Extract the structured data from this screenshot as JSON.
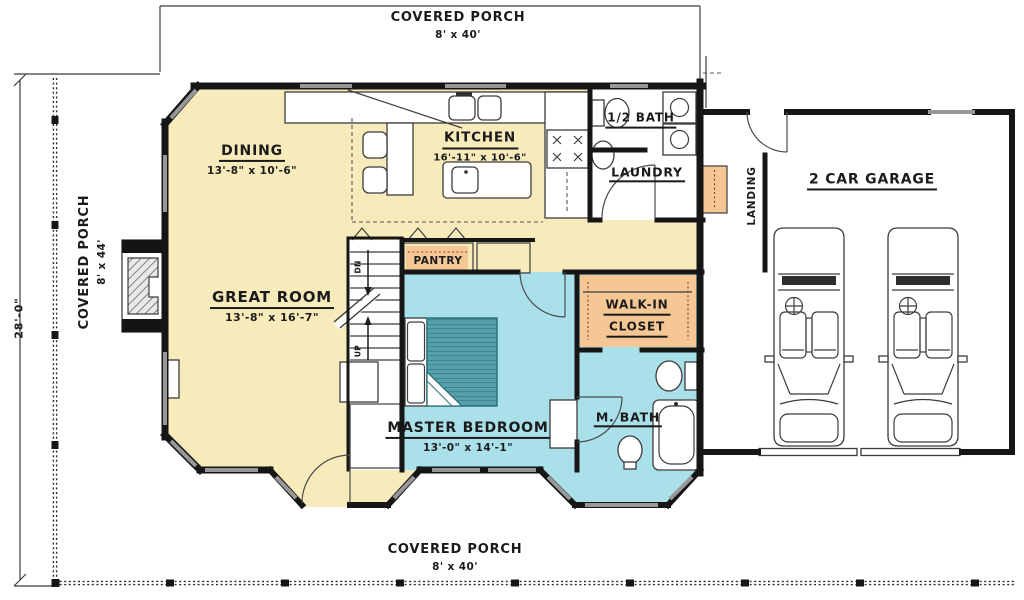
{
  "palette": {
    "floor_yellow": "#f7ebbb",
    "suite_blue": "#a9e0ea",
    "accent_orange": "#f5c795",
    "wall_black": "#161616",
    "window_gray": "#989898",
    "bed_teal": "#55a0aa"
  },
  "dimensions": {
    "left_height": "28'-0\""
  },
  "porches": {
    "top": {
      "label": "COVERED PORCH",
      "size": "8' x 40'"
    },
    "left": {
      "label": "COVERED PORCH",
      "size": "8' x 44'"
    },
    "bottom": {
      "label": "COVERED PORCH",
      "size": "8' x 40'"
    }
  },
  "rooms": {
    "dining": {
      "label": "DINING",
      "size": "13'-8\" x 10'-6\""
    },
    "kitchen": {
      "label": "KITCHEN",
      "size": "16'-11\" x 10'-6\""
    },
    "half_bath": {
      "label": "1/2 BATH"
    },
    "laundry": {
      "label": "LAUNDRY"
    },
    "landing": {
      "label": "LANDING"
    },
    "garage": {
      "label": "2 CAR GARAGE"
    },
    "great_room": {
      "label": "GREAT ROOM",
      "size": "13'-8\" x 16'-7\""
    },
    "pantry": {
      "label": "PANTRY"
    },
    "walk_in_closet": {
      "label_line1": "WALK-IN",
      "label_line2": "CLOSET"
    },
    "master_bedroom": {
      "label": "MASTER BEDROOM",
      "size": "13'-0\" x 14'-1\""
    },
    "master_bath": {
      "label": "M. BATH"
    }
  },
  "stairs": {
    "down_label": "DN",
    "up_label": "UP"
  }
}
